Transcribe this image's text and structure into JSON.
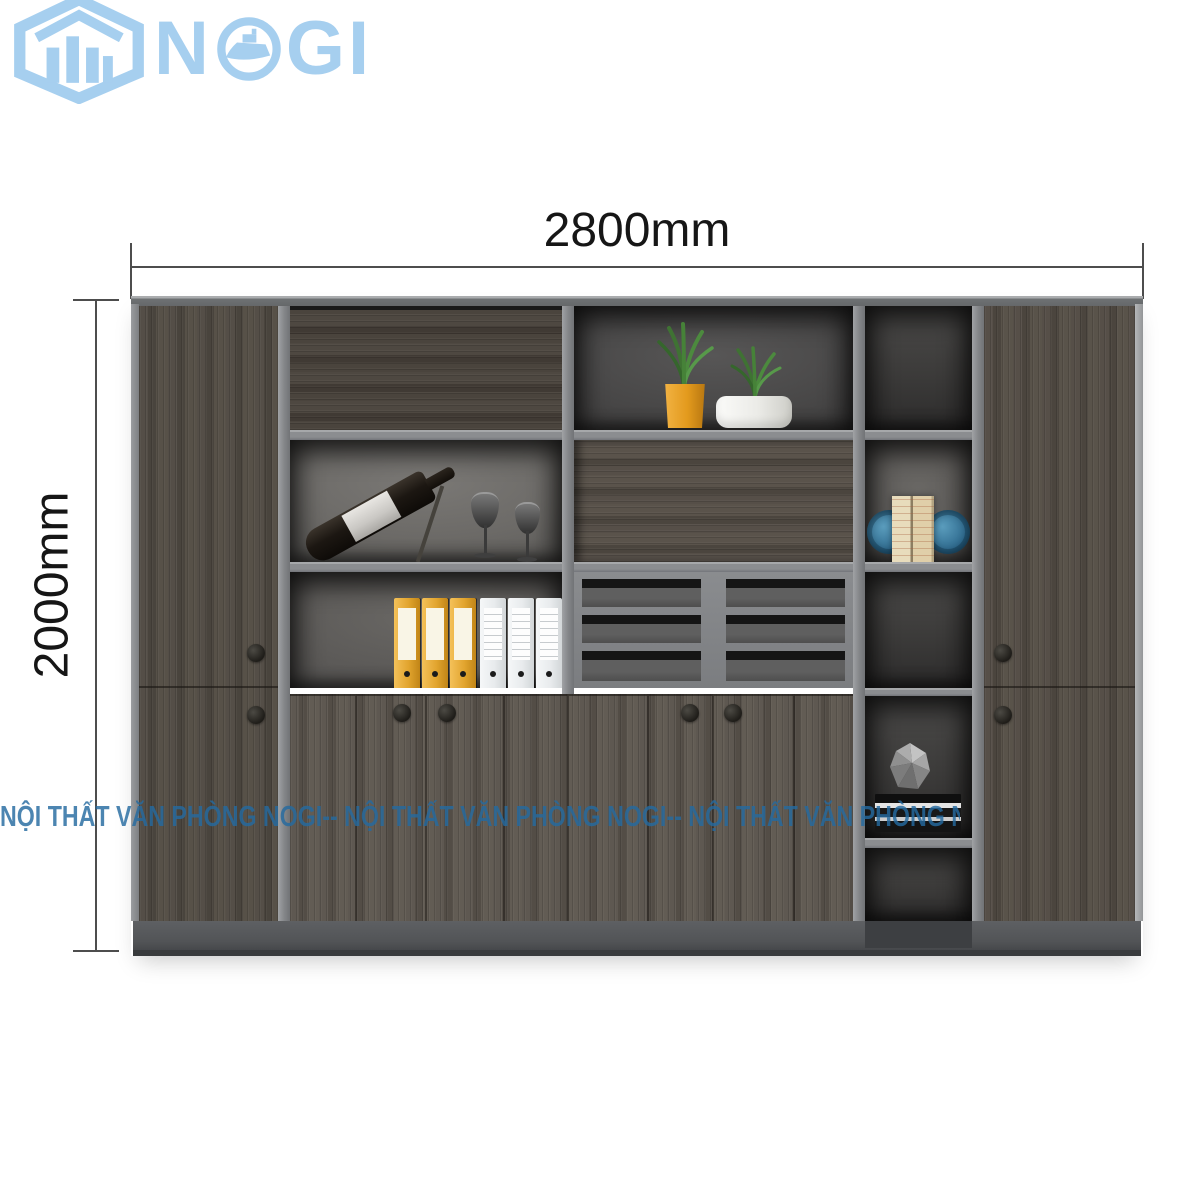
{
  "logo": {
    "name": "NOGI",
    "part1": "N",
    "part2": "GI"
  },
  "dimensions": {
    "width_label": "2800mm",
    "height_label": "2000mm"
  },
  "watermark": {
    "text": "NỘI THẤT VĂN PHÒNG NOGI-- NỘI THẤT VĂN PHÒNG NOGI-- NỘI THẤT VĂN PHÒNG NOGI -- NỘI THẤT VĂN PHÒNG NOGI"
  },
  "colors": {
    "logo_blue": "#a6cfef",
    "watermark_blue": "#246aa0",
    "dimension_text": "#161616",
    "binder_yellow": "#e2a52f",
    "pot_yellow": "#e39a1d",
    "bookend_blue": "#2f6b8f",
    "wood_dark": "#4a443d",
    "frame_grey": "#85878a"
  }
}
